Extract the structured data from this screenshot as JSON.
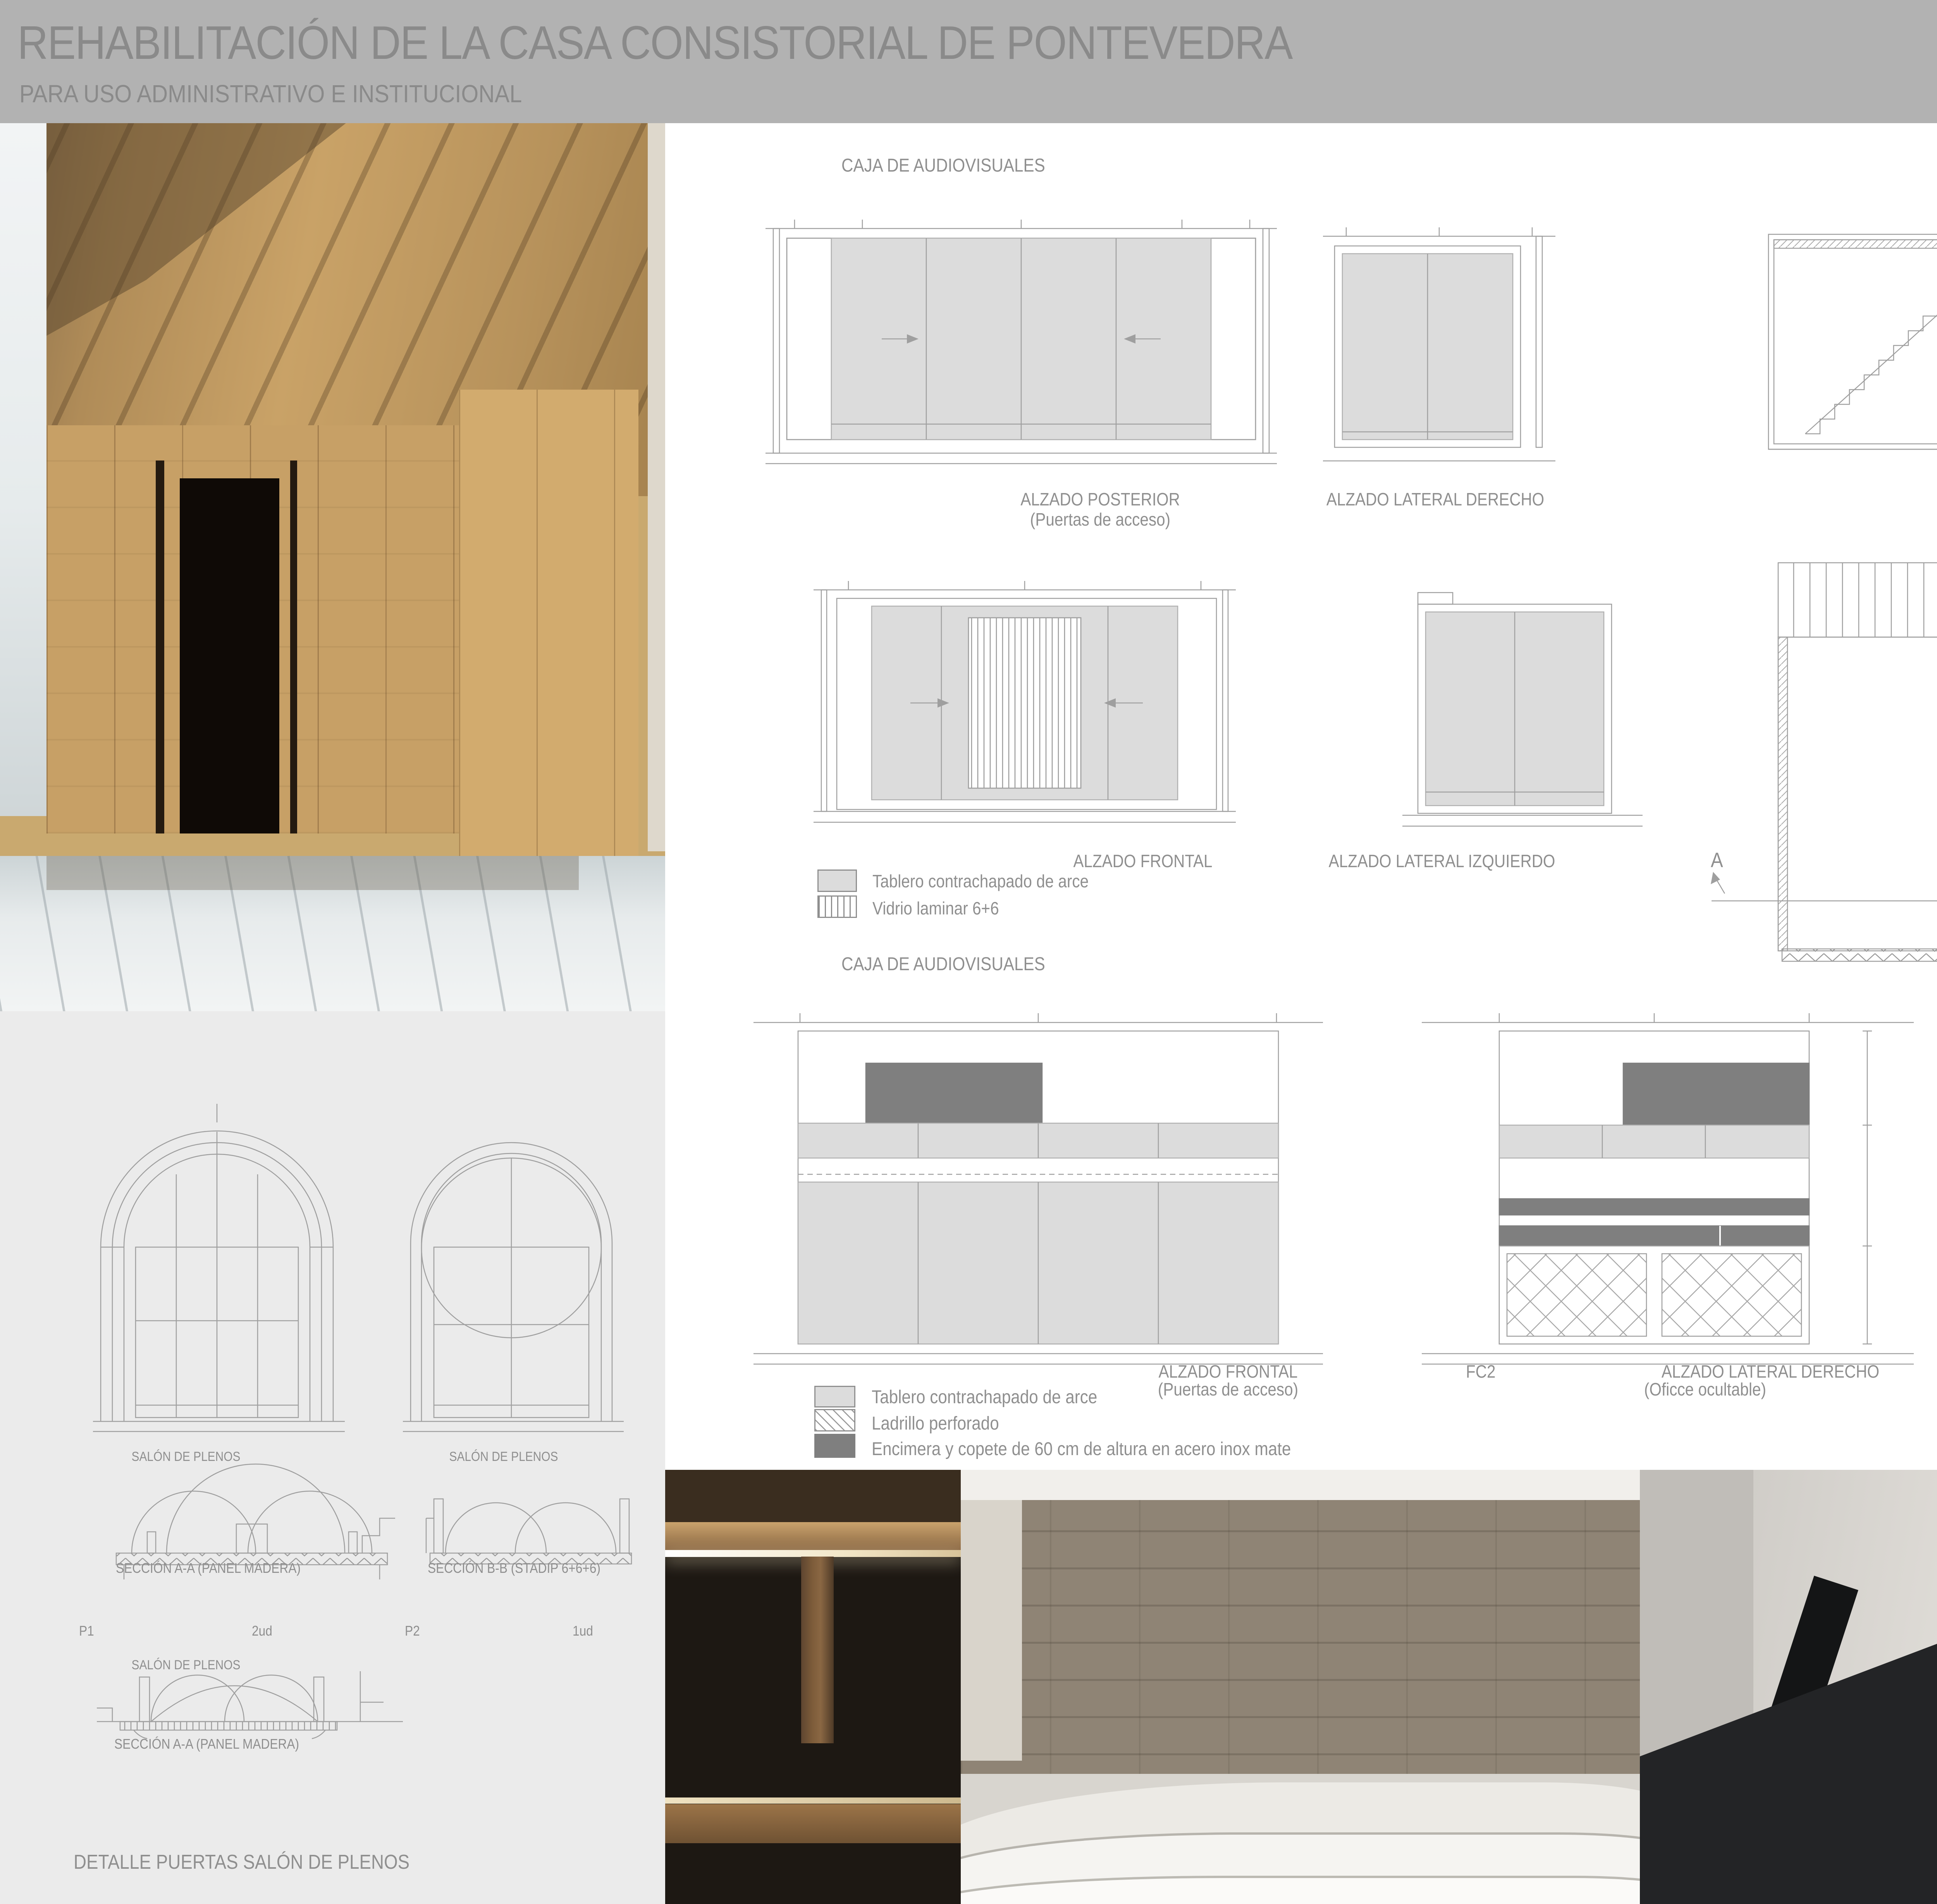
{
  "header": {
    "title": "REHABILITACIÓN DE LA CASA CONSISTORIAL DE PONTEVEDRA",
    "subtitle": "PARA USO ADMINISTRATIVO E INSTITUCIONAL",
    "sheet_title": "DETALLES",
    "firm": "Uña + Amandi Arquiectos",
    "sheet_number": "7",
    "sheet_of": "DE 7"
  },
  "av_top": {
    "title": "CAJA DE AUDIOVISUALES",
    "alzado_posterior": "ALZADO POSTERIOR",
    "alzado_posterior_sub": "(Puertas de acceso)",
    "alzado_lateral_derecho": "ALZADO LATERAL DERECHO",
    "seccion_aa": "SECCIÓN A-A´",
    "alzado_frontal": "ALZADO FRONTAL",
    "alzado_lateral_izquierdo": "ALZADO LATERAL IZQUIERDO",
    "pc2_top": "PC2",
    "pc2_bottom": "PC2",
    "planta": "PLANTA",
    "mark_a": "A",
    "mark_a_prime": "A´"
  },
  "legend_vidrio": {
    "items": [
      {
        "label": "Tablero contrachapado de arce"
      },
      {
        "label": "Vidrio laminar 6+6"
      }
    ]
  },
  "av_bottom": {
    "title": "CAJA DE AUDIOVISUALES",
    "alzado_frontal": "ALZADO FRONTAL",
    "alzado_frontal_sub": "(Puertas de acceso)",
    "fc2": "FC2",
    "alzado_lateral_derecho": "ALZADO LATERAL DERECHO",
    "alzado_lateral_derecho_sub": "(Oficce ocultable)"
  },
  "legend_oficio": {
    "items": [
      {
        "label": "Tablero contrachapado de arce"
      },
      {
        "label": "Ladrillo perforado"
      },
      {
        "label": "Encimera y copete de 60 cm de altura en acero inox mate"
      }
    ]
  },
  "ascensor": {
    "title": "CAJA DEL ASCENSOR/OFICIO",
    "alzado_lateral_izquierdo": "ALZADO LATERAL IZQUIERDO",
    "planta": "PLANTA",
    "pc2": "PC2",
    "nevera": "nevera"
  },
  "puertas": {
    "salon_label_1": "SALÓN DE PLENOS",
    "salon_label_2": "SALÓN DE PLENOS",
    "seccion_aa_panel_1": "SECCIÓN A-A (PANEL MADERA)",
    "seccion_bb_stadip": "SECCIÓN B-B (STADIP 6+6+6)",
    "p1": "P1",
    "p1_qty": "2ud",
    "p2": "P2",
    "p2_qty": "1ud",
    "salon_label_3": "SALÓN DE PLENOS",
    "seccion_aa_panel_2": "SECCIÓN A-A (PANEL MADERA)",
    "title": "DETALLE PUERTAS SALÓN DE PLENOS"
  },
  "colors": {
    "header_bg": "#b2b2b2",
    "header_text": "#8a8a8a",
    "panel_bg": "#ebebeb",
    "label_text": "#8f8f8f",
    "drawing_line": "#9f9f9f",
    "fill_plywood": "#dcdcdc",
    "fill_steel": "#7f7f7f"
  }
}
